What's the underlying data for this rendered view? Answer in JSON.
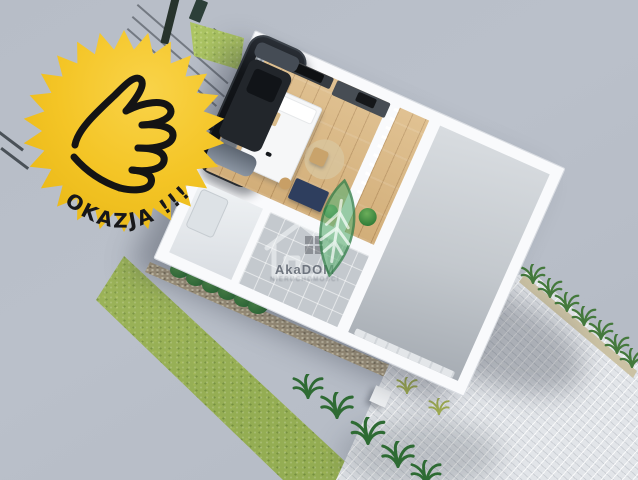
{
  "badge": {
    "label": "OKAZJA !!!",
    "icon": "thumbs-up-icon",
    "background_color": "#F2C41F",
    "text_color": "#17171A"
  },
  "watermark": {
    "brand": "AkaDOM",
    "subtext": "NIERUCHOMOŚCI",
    "logo_icon": "house-outline-icon",
    "leaf_icon": "leaf-tree-icon",
    "leaf_color": "#5BAD72"
  },
  "scene": {
    "type": "3D architectural render",
    "description": "Top-down 3D visualization of a small single-storey house with furnished interior (wood floors, bed, desk, kitchen wall unit), corridor with railing, tiled entry, bathroom, and attached garage with a black car; lawn strip with hedge on the left, palm-lined paved driveway at bottom right, wire fence at top left",
    "background_color": "#BAC0CA",
    "house": {
      "walls_color": "#F9FAFC",
      "wood_floor_color": "#DCB983",
      "garage_floor_color": "#C3C8CD",
      "entry_tile_color": "#C4C9CE",
      "car_color": "#121519",
      "rooms": [
        "living room",
        "corridor",
        "entry hall",
        "bathroom",
        "garage"
      ]
    },
    "landscape": {
      "lawn_color": "#94AD53",
      "hedge_color": "#3F8A42",
      "driveway_color": "#E2E5E9",
      "palm_color": "#44793C",
      "gravel_color": "#B3A486"
    }
  }
}
